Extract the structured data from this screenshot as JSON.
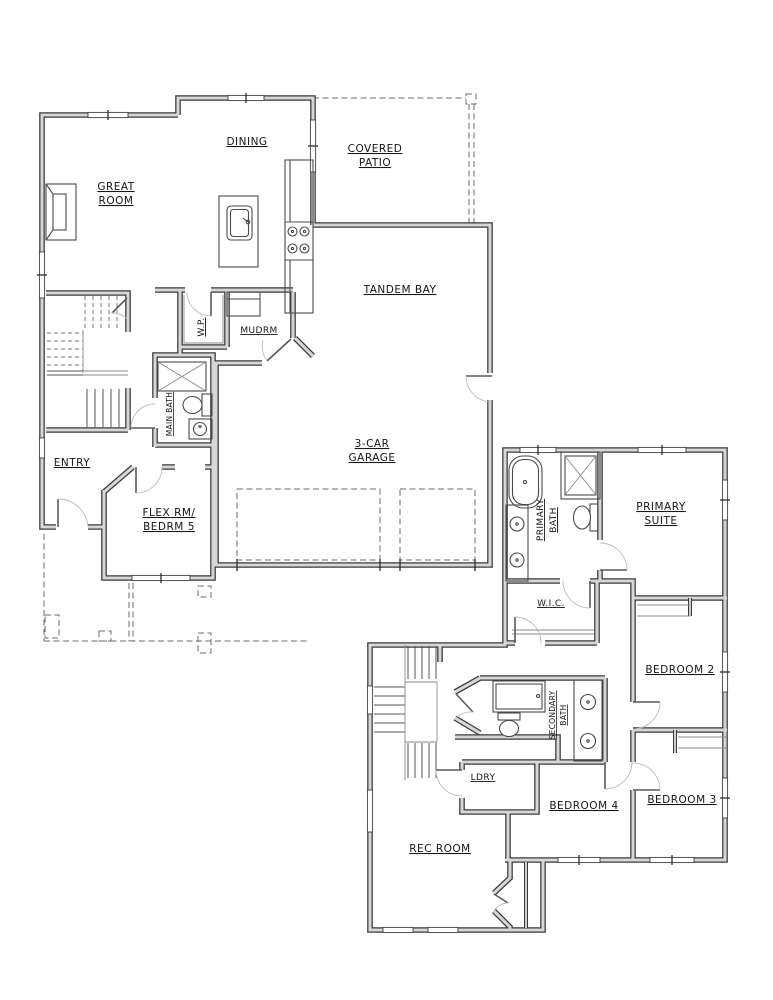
{
  "colors": {
    "background": "#ffffff",
    "wall_edge": "#383838",
    "wall_fill": "#d7d7d7",
    "fixture_line": "#4a4a4a",
    "label_text": "#161616"
  },
  "floor1": {
    "rooms": {
      "great_room": {
        "line1": "GREAT",
        "line2": "ROOM"
      },
      "dining": {
        "label": "DINING"
      },
      "covered_patio": {
        "line1": "COVERED",
        "line2": "PATIO"
      },
      "tandem_bay": {
        "label": "TANDEM BAY"
      },
      "garage": {
        "line1": "3-CAR",
        "line2": "GARAGE"
      },
      "pantry": {
        "label": "W.P."
      },
      "mudroom": {
        "label": "MUDRM"
      },
      "main_bath": {
        "label": "MAIN BATH"
      },
      "entry": {
        "label": "ENTRY"
      },
      "flex": {
        "line1": "FLEX RM/",
        "line2": "BEDRM 5"
      }
    }
  },
  "floor2": {
    "rooms": {
      "primary_bath": {
        "line1": "PRIMARY",
        "line2": "BATH"
      },
      "primary_suite": {
        "line1": "PRIMARY",
        "line2": "SUITE"
      },
      "wic": {
        "label": "W.I.C."
      },
      "bedroom2": {
        "label": "BEDROOM 2"
      },
      "secondary_bath": {
        "line1": "SECONDARY",
        "line2": "BATH"
      },
      "laundry": {
        "label": "LDRY"
      },
      "bedroom4": {
        "label": "BEDROOM 4"
      },
      "bedroom3": {
        "label": "BEDROOM 3"
      },
      "rec_room": {
        "label": "REC ROOM"
      }
    }
  }
}
